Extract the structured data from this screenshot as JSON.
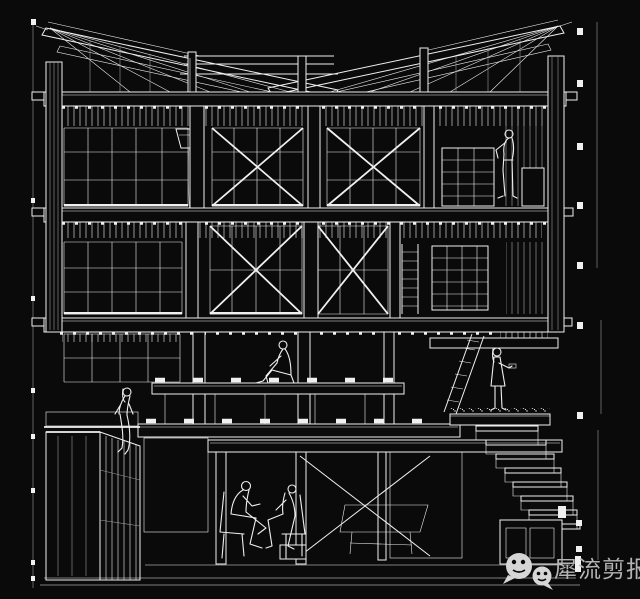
{
  "colors": {
    "background": "#0a0a0a",
    "line": "#f0f0f0",
    "line_dim": "#9a9a9a",
    "watermark_text": "#b4b4b4",
    "watermark_icon": "#d6d6d6"
  },
  "watermark": {
    "text": "犀流剪报",
    "icon": "wechat-icon"
  },
  "drawing": {
    "alt": "White-on-black architectural sectional perspective line drawing of a three-storey braced timber/steel frame building with roof trusses, X-braced window bays, ladders, a right-hand staircase, a basement with two seated figures, and four more human figures on the floors",
    "figure_count": 6
  }
}
